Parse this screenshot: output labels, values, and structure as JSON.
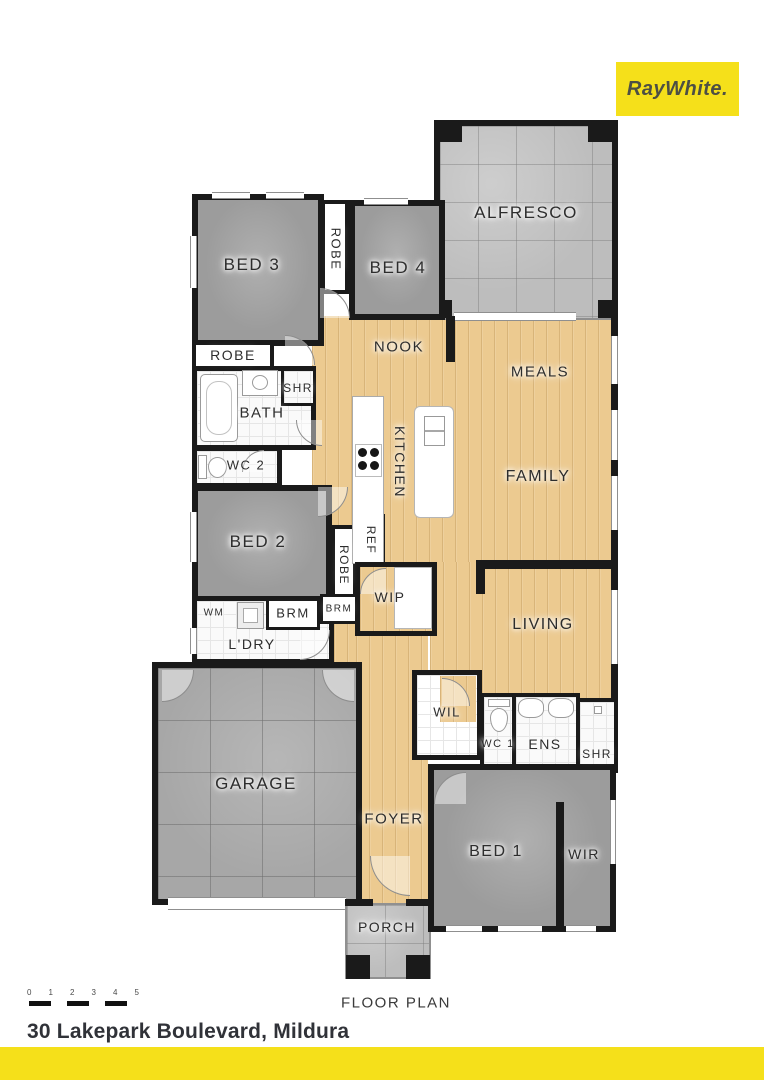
{
  "brand": {
    "logo_text": "RayWhite."
  },
  "plan": {
    "title": "FLOOR PLAN"
  },
  "address": "30 Lakepark Boulevard, Mildura",
  "scale": {
    "numbers": [
      "0",
      "1",
      "2",
      "3",
      "4",
      "5"
    ]
  },
  "rooms": {
    "alfresco": "ALFRESCO",
    "bed3": "BED 3",
    "robe_beds": "ROBE",
    "bed4": "BED 4",
    "nook": "NOOK",
    "meals": "MEALS",
    "robe_bed3": "ROBE",
    "shr_bath": "SHR",
    "bath": "BATH",
    "wc2": "WC 2",
    "kitchen": "KITCHEN",
    "family": "FAMILY",
    "bed2": "BED 2",
    "ref": "REF",
    "robe_bed2": "ROBE",
    "wip": "WIP",
    "living": "LIVING",
    "wm": "WM",
    "brm1": "BRM",
    "brm2": "BRM",
    "ldry": "L'DRY",
    "garage": "GARAGE",
    "foyer": "FOYER",
    "wil": "WIL",
    "wc1": "WC 1",
    "ens": "ENS",
    "shr_ens": "SHR",
    "bed1": "BED 1",
    "wir": "WIR",
    "porch": "PORCH"
  },
  "colors": {
    "brand_yellow": "#F5E01A",
    "wall": "#1A1A1A",
    "wood_floor": "#ECCA90",
    "carpet": "#9C9C9C",
    "tile_light": "#BDBDBD",
    "tile_dark": "#A7A7A7",
    "label_text": "#2D2D2D"
  }
}
